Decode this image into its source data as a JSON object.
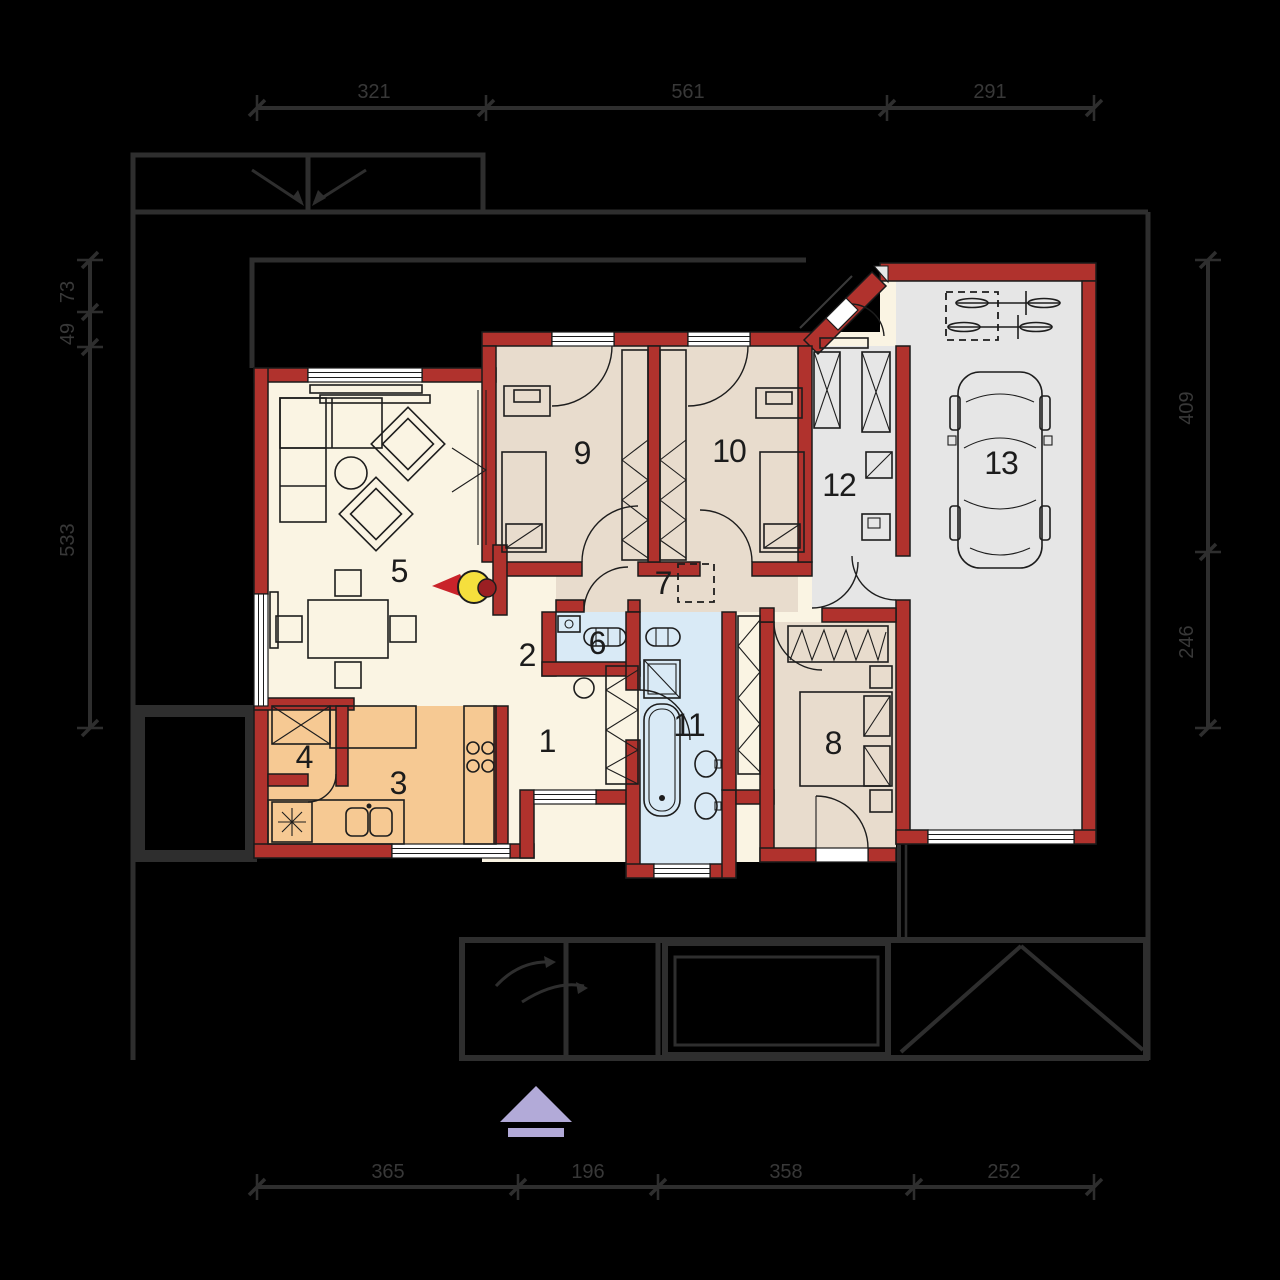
{
  "title": "single-storey house floor plan with garage",
  "rooms": {
    "r1": "1",
    "r2": "2",
    "r3": "3",
    "r4": "4",
    "r5": "5",
    "r6": "6",
    "r7": "7",
    "r8": "8",
    "r9": "9",
    "r10": "10",
    "r11": "11",
    "r12": "12",
    "r13": "13"
  },
  "dims": {
    "top": [
      "321",
      "561",
      "291"
    ],
    "bottom": [
      "365",
      "196",
      "358",
      "252"
    ],
    "left": [
      "73",
      "49",
      "533"
    ],
    "right": [
      "409",
      "246"
    ]
  },
  "symbols": {
    "north_arrow": "north-arrow",
    "fireplace": "fireplace",
    "car": "car-top-view",
    "bicycles": "bicycles",
    "skylight": "dashed-opening",
    "driveway_arrows": "entrance-direction-arrows",
    "fridge": "fridge-snowflake",
    "hob": "cooktop-4-burners"
  },
  "colors": {
    "background": "#000000",
    "wall_red": "#b0322d",
    "floor_main": "#faf4e3",
    "floor_bedroom": "#e8dccd",
    "floor_kitchen": "#f6c993",
    "floor_bath": "#d9eaf6",
    "floor_garage": "#e6e6e6",
    "site_lines": "#2e2e2e",
    "fire_yellow": "#f5df3d",
    "fire_red": "#c9232a",
    "north_purple": "#b2aad8"
  }
}
